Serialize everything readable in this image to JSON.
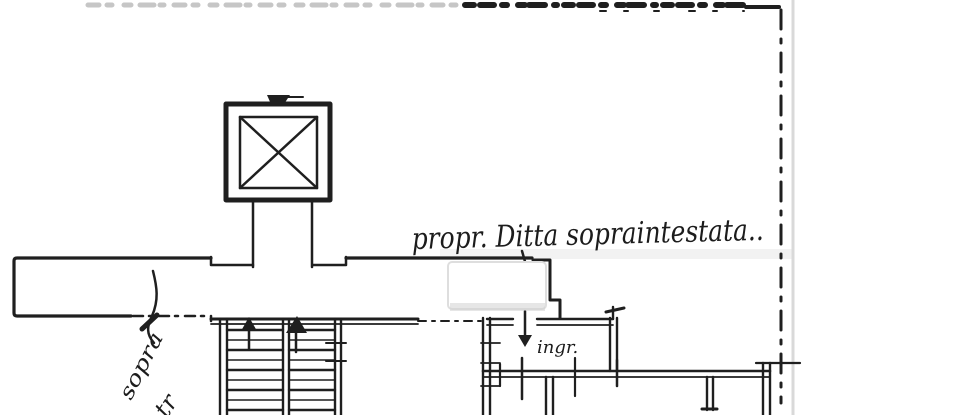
{
  "page": {
    "background": "#ffffff"
  },
  "drawing": {
    "ink_color": "#1f1f1f",
    "faint_color": "#c6c6c6",
    "page_edge_color": "#d9d9d9"
  },
  "labels": {
    "main_note": "propr. Ditta sopraintestata..",
    "entrance": "ingr.",
    "side_note": "sopra",
    "side_note_partial": "tr"
  }
}
